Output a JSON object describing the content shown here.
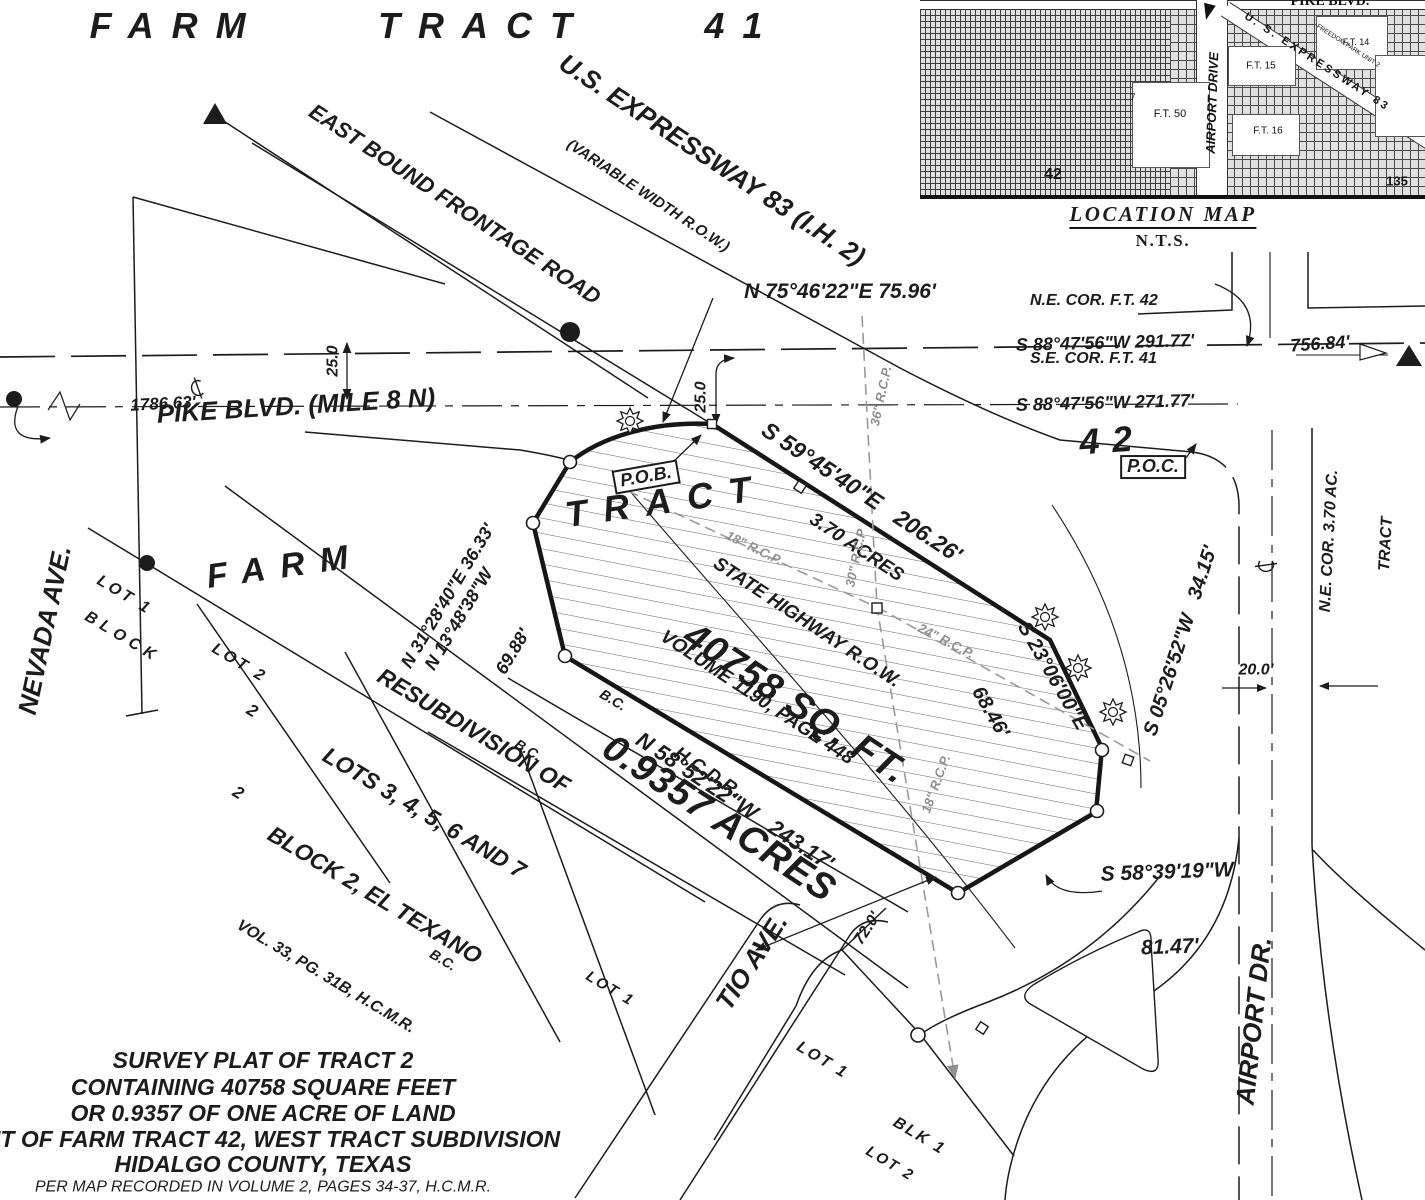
{
  "colors": {
    "ink": "#1c1c1c",
    "pipe_grey": "#8f8f8f",
    "paper": "#ffffff"
  },
  "header": {
    "farm_tract_41": "FARM TRACT 41"
  },
  "roads": {
    "us_expressway": "U.S. EXPRESSWAY 83 (I.H. 2)",
    "variable_width": "(VARIABLE WIDTH R.O.W.)",
    "east_bound_frontage": "EAST BOUND FRONTAGE ROAD",
    "pike_blvd": "PIKE BLVD. (MILE 8 N)",
    "airport_dr": "AIRPORT DR.",
    "tio_ave": "TIO AVE.",
    "nevada_ave": "NEVADA AVE."
  },
  "bearings": {
    "n754622": "N 75°46'22\"E 75.96'",
    "s884756_291": "S 88°47'56\"W 291.77'",
    "s884756_271": "S 88°47'56\"W 271.77'",
    "s594540": "S 59°45'40\"E   206.26'",
    "s230600": "S 23°06'00\"E",
    "d6846": "68.46'",
    "s052652": "S 05°26'52\"W   34.15'",
    "n312840": "N 31°28'40\"E 36.33'",
    "n134838": "N 13°48'38\"W",
    "d6988": "69.88'",
    "n585222": "N 58°52'22\"W   243.17'",
    "s583919": "S 58°39'19\"W",
    "d8147": "81.47'"
  },
  "distances": {
    "d75684": "756.84'",
    "d178663": "1786.63'",
    "d25": "25.0",
    "d200": "20.0'",
    "d720": "72.0'"
  },
  "corners": {
    "ne_cor_ft42": "N.E. COR. F.T. 42",
    "se_cor_ft41": "S.E. COR. F.T. 41",
    "ne_cor_370": "N.E. COR. 3.70 AC.",
    "ne_cor_370b": "TRACT",
    "pob": "P.O.B.",
    "poc": "P.O.C."
  },
  "parcel": {
    "tract_word": "TRACT",
    "num_42": "42",
    "acres_370": "3.70 ACRES",
    "row_line": "STATE HIGHWAY R.O.W.",
    "volume": "VOLUME 1190, PAGE 448",
    "hcdr": "H.C.D.R.",
    "sqft": "40758 SQ. FT.",
    "acres": "0.9357 ACRES",
    "bc": "B.C."
  },
  "pipes": {
    "rcp36": "36\" R.C.P.",
    "rcp30": "30\" R.C.P",
    "rcp24": "24\" R.C.P.",
    "rcp18": "18\" R.C.P."
  },
  "subdivision": {
    "farm_word": "FARM",
    "lot1": "LOT 1",
    "lot2": "LOT 2",
    "block_word": "BLOCK",
    "block_num": "2",
    "blk1": "BLK 1",
    "resub1": "RESUBDIVISION OF",
    "resub2": "LOTS 3, 4, 5, 6 AND 7",
    "resub3": "BLOCK 2, EL TEXANO",
    "resub4": "VOL. 33, PG. 31B, H.C.M.R."
  },
  "title_block": {
    "line1": "SURVEY PLAT OF TRACT 2",
    "line2": "CONTAINING 40758 SQUARE FEET",
    "line3": "OR 0.9357 OF ONE ACRE OF LAND",
    "line4": "OUT OF FARM TRACT 42, WEST TRACT SUBDIVISION",
    "line5": "HIDALGO COUNTY, TEXAS",
    "line6": "PER MAP RECORDED IN VOLUME 2, PAGES 34-37, H.C.M.R."
  },
  "location_map": {
    "title": "LOCATION MAP",
    "scale": "N.T.S.",
    "pike_blvd": "PIKE BLVD.",
    "expressway": "U. S. EXPRESSWAY 83",
    "airport_drive": "AIRPORT DRIVE",
    "freedom_park": "FREEDOM PARK UNIT 2",
    "ft50": "F.T. 50",
    "ft15": "F.T. 15",
    "ft16": "F.T. 16",
    "ft14": "F.T. 14",
    "tract42": "42",
    "tract135": "135",
    "tract7": "7"
  },
  "symbols": {
    "found_monument": "filled-circle",
    "control_monument": "filled-triangle",
    "set_point": "open-circle",
    "inlet": "open-square",
    "ornamental_marker": "sunburst-icon",
    "centerline": "CL-symbol"
  }
}
